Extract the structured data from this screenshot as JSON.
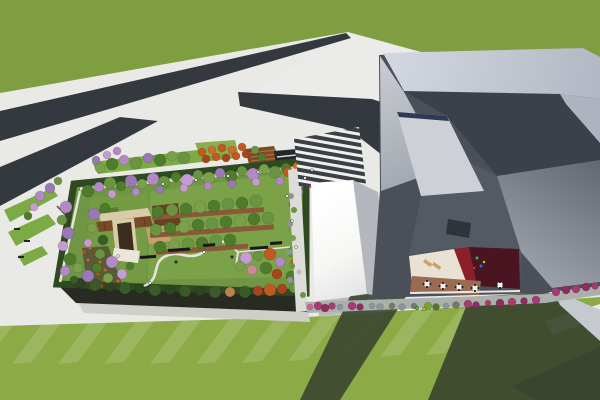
{
  "scene": {
    "type": "architectural-3d-rendering",
    "description": "Aerial view of a campus: low building with rooftop garden park, striped entry plaza, white service hall, large faceted gray museum-like building with inner courtyard cafe, roads crossing a grass field, lawns with long building shadows."
  },
  "palette": {
    "grass": "#7e9e40",
    "pavement": "#e9e9e6",
    "pavementWedge": "#ebebe9",
    "pavementShade": "#cfcfca",
    "road": "#34383f",
    "roadSE": "#3a3e45",
    "lawn": "#8caa45",
    "gardenLawn": "#6f9545",
    "gardenLawnLight": "#7ba249",
    "gardenLawnLeft": "#759c45",
    "hedge": "#2f4a21",
    "gardenFacade": "#272b22",
    "stripGreen": "#7cab45",
    "stripGreen2": "#86b04c",
    "amphitheater": "#7d4a26",
    "amphitheaterStep": "#a9713d",
    "shelter": "#23262b",
    "whiteRoofSide": "#b4b8be",
    "bldgBase": "#4a4f58",
    "bldgDarkNorth": "#3c4149",
    "bldgSouthWest": "#545a63",
    "bandRight": "#aeb3bf",
    "skylight": "#cdd1d7",
    "skylightStrip": "#2c3a55",
    "vent": "#2f343b",
    "courtyardCream": "#e9e1d4",
    "courtyardDarkRed": "#8c1f2a",
    "courtyardMaroon": "#4a1420",
    "courtyardTerracotta": "#9c6a50",
    "curb": "#e8e8e6",
    "walkwayBand": "#aab0ac",
    "rightWall": "#c6c9cd",
    "shadow": "#3a452e",
    "eastWalk": "#dcdcd8",
    "pathLight": "#e7e4da",
    "pergolaWood": "#7a4a28",
    "pergolaFrame": "#d8cba8",
    "pergolaInner": "#3a2d1e",
    "deck": "#c8a06b",
    "planterBox": "#6b3f22",
    "soil": "#4a4030",
    "zebraLight": "#f0f0ee",
    "zebraDark": "#3b3f46",
    "whitePath": "#e9eae8"
  },
  "vegetation": {
    "gardenNorthTrees": [
      [
        88,
        191,
        6,
        "#4e7c2c"
      ],
      [
        99,
        187,
        5,
        "#b487c6"
      ],
      [
        110,
        183,
        6,
        "#699441"
      ],
      [
        121,
        186,
        5,
        "#4e7c2c"
      ],
      [
        131,
        181,
        6,
        "#9a77b5"
      ],
      [
        142,
        184,
        5,
        "#7ba04b"
      ],
      [
        153,
        179,
        6,
        "#b487c6"
      ],
      [
        164,
        182,
        6,
        "#699441"
      ],
      [
        176,
        177,
        5,
        "#4e7c2c"
      ],
      [
        187,
        180,
        6,
        "#c79ad3"
      ],
      [
        198,
        175,
        5,
        "#699441"
      ],
      [
        209,
        178,
        6,
        "#7ba04b"
      ],
      [
        220,
        173,
        5,
        "#9a77b5"
      ],
      [
        231,
        176,
        6,
        "#4e7c2c"
      ],
      [
        242,
        171,
        5,
        "#699441"
      ],
      [
        253,
        174,
        6,
        "#b487c6"
      ],
      [
        264,
        169,
        5,
        "#7ba04b"
      ],
      [
        275,
        172,
        6,
        "#699441"
      ],
      [
        286,
        168,
        5,
        "#4e7c2c"
      ],
      [
        288,
        172,
        5,
        "#c2581f"
      ],
      [
        297,
        166,
        4,
        "#d06b28"
      ],
      [
        112,
        194,
        4,
        "#c79ad3"
      ],
      [
        136,
        192,
        4,
        "#b487c6"
      ],
      [
        160,
        190,
        4,
        "#9a77b5"
      ],
      [
        184,
        188,
        4,
        "#c79ad3"
      ],
      [
        208,
        186,
        4,
        "#b487c6"
      ],
      [
        232,
        184,
        4,
        "#9a77b5"
      ],
      [
        256,
        182,
        4,
        "#c79ad3"
      ],
      [
        280,
        181,
        4,
        "#b487c6"
      ]
    ],
    "gardenEastTrees": [
      [
        295,
        180,
        5,
        "#699441"
      ],
      [
        298,
        192,
        5,
        "#b487c6"
      ],
      [
        294,
        204,
        5,
        "#4e7c2c"
      ],
      [
        297,
        216,
        5,
        "#9a77b5"
      ],
      [
        293,
        228,
        5,
        "#7ba04b"
      ],
      [
        296,
        240,
        5,
        "#c79ad3"
      ],
      [
        292,
        252,
        5,
        "#699441"
      ],
      [
        295,
        264,
        5,
        "#c2641f"
      ],
      [
        291,
        276,
        5,
        "#4e7c2c"
      ]
    ],
    "gardenSouthTrees": [
      [
        80,
        283,
        5,
        "#2c451e"
      ],
      [
        95,
        285,
        6,
        "#3a5a28"
      ],
      [
        110,
        287,
        5,
        "#2c451e"
      ],
      [
        125,
        288,
        6,
        "#3a5a28"
      ],
      [
        140,
        289,
        5,
        "#2c451e"
      ],
      [
        155,
        290,
        6,
        "#3a5a28"
      ],
      [
        170,
        290,
        5,
        "#2c451e"
      ],
      [
        185,
        291,
        6,
        "#3a5a28"
      ],
      [
        200,
        291,
        5,
        "#2c451e"
      ],
      [
        215,
        292,
        6,
        "#3a5a28"
      ],
      [
        230,
        292,
        5,
        "#b9844b"
      ],
      [
        245,
        292,
        6,
        "#3a5a28"
      ],
      [
        258,
        291,
        5,
        "#a8431a"
      ],
      [
        270,
        290,
        6,
        "#c2581f"
      ],
      [
        282,
        289,
        5,
        "#a8431a"
      ],
      [
        294,
        288,
        5,
        "#699441"
      ]
    ],
    "gardenWestTrees": [
      [
        66,
        207,
        6,
        "#b487c6"
      ],
      [
        62,
        220,
        5,
        "#699441"
      ],
      [
        68,
        233,
        6,
        "#9a77b5"
      ],
      [
        63,
        246,
        5,
        "#c79ad3"
      ],
      [
        70,
        259,
        6,
        "#4e7c2c"
      ],
      [
        65,
        271,
        5,
        "#b487c6"
      ],
      [
        78,
        268,
        5,
        "#7ba04b"
      ],
      [
        74,
        280,
        4,
        "#3a5a28"
      ]
    ],
    "gardenRowTrees": [
      [
        158,
        212,
        6,
        "#4e7c2c"
      ],
      [
        172,
        210,
        6,
        "#699441"
      ],
      [
        186,
        209,
        6,
        "#4e7c2c"
      ],
      [
        200,
        207,
        6,
        "#7ba04b"
      ],
      [
        214,
        206,
        6,
        "#4e7c2c"
      ],
      [
        228,
        204,
        6,
        "#699441"
      ],
      [
        242,
        203,
        6,
        "#4e7c2c"
      ],
      [
        256,
        201,
        6,
        "#699441"
      ],
      [
        156,
        230,
        6,
        "#699441"
      ],
      [
        170,
        228,
        6,
        "#4e7c2c"
      ],
      [
        184,
        227,
        6,
        "#7ba04b"
      ],
      [
        198,
        225,
        6,
        "#4e7c2c"
      ],
      [
        212,
        224,
        6,
        "#699441"
      ],
      [
        226,
        222,
        6,
        "#4e7c2c"
      ],
      [
        240,
        221,
        6,
        "#7ba04b"
      ],
      [
        254,
        219,
        6,
        "#4e7c2c"
      ],
      [
        268,
        218,
        6,
        "#699441"
      ],
      [
        160,
        247,
        6,
        "#4e7c2c"
      ],
      [
        174,
        246,
        6,
        "#7ba04b"
      ],
      [
        188,
        244,
        6,
        "#699441"
      ],
      [
        202,
        243,
        6,
        "#4e7c2c"
      ],
      [
        216,
        241,
        6,
        "#699441"
      ],
      [
        230,
        240,
        6,
        "#4e7c2c"
      ]
    ],
    "gardenSECluster": [
      [
        246,
        258,
        6,
        "#c79ad3"
      ],
      [
        258,
        256,
        5,
        "#699441"
      ],
      [
        270,
        254,
        6,
        "#c2581f"
      ],
      [
        280,
        262,
        5,
        "#b487c6"
      ],
      [
        266,
        268,
        6,
        "#4e7c2c"
      ],
      [
        252,
        270,
        5,
        "#c9899a"
      ],
      [
        240,
        266,
        5,
        "#7ba04b"
      ],
      [
        277,
        274,
        5,
        "#a8431a"
      ]
    ],
    "gardenNWCluster": [
      [
        94,
        214,
        6,
        "#9a77b5"
      ],
      [
        105,
        208,
        5,
        "#4e7c2c"
      ],
      [
        92,
        228,
        5,
        "#7ba04b"
      ],
      [
        103,
        240,
        5,
        "#3a5a28"
      ],
      [
        88,
        243,
        4,
        "#c79ad3"
      ],
      [
        100,
        254,
        5,
        "#699441"
      ],
      [
        112,
        262,
        6,
        "#b487c6"
      ],
      [
        97,
        268,
        5,
        "#4e7c2c"
      ],
      [
        88,
        276,
        6,
        "#9a77b5"
      ],
      [
        108,
        278,
        5,
        "#7ba04b"
      ],
      [
        122,
        274,
        5,
        "#c79ad3"
      ],
      [
        130,
        266,
        4,
        "#4e7c2c"
      ]
    ],
    "northStripTrees": [
      [
        100,
        168,
        5,
        "#7ba04b"
      ],
      [
        112,
        164,
        6,
        "#4e7c2c"
      ],
      [
        124,
        160,
        5,
        "#b487c6"
      ],
      [
        136,
        163,
        6,
        "#699441"
      ],
      [
        148,
        158,
        5,
        "#9a77b5"
      ],
      [
        160,
        160,
        6,
        "#4e7c2c"
      ],
      [
        172,
        156,
        5,
        "#7ba04b"
      ],
      [
        184,
        158,
        6,
        "#699441"
      ],
      [
        202,
        152,
        4,
        "#c2581f"
      ],
      [
        212,
        150,
        4,
        "#d06b28"
      ],
      [
        222,
        148,
        4,
        "#c2581f"
      ],
      [
        232,
        150,
        4,
        "#d06b28"
      ],
      [
        242,
        147,
        4,
        "#c2581f"
      ],
      [
        206,
        159,
        4,
        "#a8431a"
      ],
      [
        216,
        157,
        4,
        "#c2581f"
      ],
      [
        226,
        158,
        4,
        "#a8431a"
      ],
      [
        236,
        156,
        4,
        "#c2581f"
      ],
      [
        246,
        154,
        4,
        "#a8431a"
      ],
      [
        255,
        150,
        4,
        "#699441"
      ],
      [
        262,
        157,
        4,
        "#4e7c2c"
      ],
      [
        107,
        155,
        4,
        "#c79ad3"
      ],
      [
        117,
        151,
        4,
        "#b487c6"
      ],
      [
        96,
        160,
        4,
        "#9a77b5"
      ]
    ],
    "leftStripTrees": [
      [
        40,
        196,
        5,
        "#b487c6"
      ],
      [
        50,
        188,
        5,
        "#9a77b5"
      ],
      [
        58,
        181,
        4,
        "#699441"
      ],
      [
        34,
        207,
        4,
        "#c79ad3"
      ],
      [
        28,
        216,
        4,
        "#4e7c2c"
      ]
    ],
    "eastWalkBushes": [
      [
        291,
        196,
        3,
        "#8f949a"
      ],
      [
        294,
        210,
        3,
        "#699441"
      ],
      [
        290,
        224,
        3,
        "#8f949a"
      ],
      [
        293,
        238,
        3,
        "#7ba04b"
      ],
      [
        289,
        252,
        3,
        "#8f949a"
      ],
      [
        292,
        266,
        3,
        "#699441"
      ],
      [
        290,
        280,
        3,
        "#8f949a"
      ],
      [
        303,
        295,
        3,
        "#699441"
      ]
    ],
    "zebraFlowers": [
      [
        312,
        186,
        2.5,
        "#a83a72"
      ],
      [
        318,
        188,
        2.5,
        "#e8e4ea"
      ],
      [
        324,
        186,
        2.5,
        "#c66292"
      ],
      [
        330,
        188,
        2.5,
        "#a83a72"
      ],
      [
        336,
        187,
        2.5,
        "#e8e4ea"
      ],
      [
        342,
        188,
        2.5,
        "#a83a72"
      ],
      [
        348,
        189,
        2.5,
        "#c66292"
      ],
      [
        354,
        190,
        2.5,
        "#a83a72"
      ]
    ],
    "southBushes": [
      [
        310,
        307,
        3,
        "#c66292"
      ],
      [
        318,
        306,
        4,
        "#a83a72"
      ],
      [
        325,
        308,
        4,
        "#8e2d5f"
      ],
      [
        332,
        306,
        3.5,
        "#a83a72"
      ],
      [
        340,
        307,
        3,
        "#8f949a"
      ],
      [
        352,
        306,
        4,
        "#a83a72"
      ],
      [
        360,
        307,
        3.5,
        "#8e2d5f"
      ],
      [
        372,
        306,
        3,
        "#8f949a"
      ],
      [
        380,
        307,
        3.5,
        "#8f949a"
      ],
      [
        392,
        306,
        3,
        "#747a6a"
      ],
      [
        402,
        307,
        3.5,
        "#8f949a"
      ],
      [
        414,
        306,
        3,
        "#747a6a"
      ],
      [
        428,
        306,
        4,
        "#7da03a"
      ],
      [
        436,
        307,
        3.5,
        "#55752c"
      ],
      [
        446,
        306,
        3,
        "#8f949a"
      ],
      [
        456,
        305,
        3.5,
        "#747a6a"
      ],
      [
        468,
        304,
        4,
        "#a83a72"
      ],
      [
        476,
        305,
        3.5,
        "#8e2d5f"
      ],
      [
        488,
        303,
        3,
        "#a83a72"
      ],
      [
        500,
        303,
        4,
        "#8e2d5f"
      ],
      [
        512,
        302,
        4,
        "#a83a72"
      ],
      [
        524,
        301,
        3.5,
        "#8e2d5f"
      ],
      [
        536,
        300,
        4,
        "#a83a72"
      ],
      [
        556,
        292,
        4,
        "#a83a72"
      ],
      [
        566,
        290,
        4,
        "#8e2d5f"
      ],
      [
        576,
        289,
        4,
        "#a83a72"
      ],
      [
        586,
        287,
        4,
        "#8e2d5f"
      ],
      [
        595,
        286,
        3.5,
        "#a83a72"
      ]
    ],
    "redFlowerBed": [
      [
        84,
        252,
        1.8,
        "#cf4418"
      ],
      [
        90,
        248,
        1.5,
        "#e25b28"
      ],
      [
        96,
        255,
        1.8,
        "#cf4418"
      ],
      [
        88,
        260,
        1.5,
        "#e25b28"
      ],
      [
        94,
        266,
        1.8,
        "#cf4418"
      ],
      [
        100,
        262,
        1.5,
        "#e25b28"
      ],
      [
        86,
        272,
        1.8,
        "#cf4418"
      ],
      [
        92,
        278,
        1.5,
        "#e25b28"
      ],
      [
        98,
        274,
        1.8,
        "#cf4418"
      ],
      [
        104,
        280,
        1.5,
        "#e25b28"
      ],
      [
        110,
        277,
        1.8,
        "#cf4418"
      ],
      [
        105,
        270,
        1.5,
        "#e25b28"
      ],
      [
        112,
        284,
        1.8,
        "#cf4418"
      ],
      [
        118,
        281,
        1.5,
        "#e25b28"
      ],
      [
        101,
        286,
        1.8,
        "#cf4418"
      ]
    ]
  },
  "furniture": {
    "planterStrips": [
      [
        152,
        215,
        112,
        5,
        -4,
        "#8a5a38"
      ],
      [
        150,
        233,
        124,
        5,
        -4,
        "#8a5a38"
      ],
      [
        156,
        250,
        92,
        5,
        -4,
        "#8a5a38"
      ]
    ],
    "benches": [
      [
        168,
        249,
        22,
        3,
        -4,
        "#17181a"
      ],
      [
        203,
        244,
        12,
        3,
        -4,
        "#17181a"
      ],
      [
        140,
        256,
        16,
        3,
        -4,
        "#17181a"
      ],
      [
        250,
        247,
        18,
        3,
        -4,
        "#17181a"
      ],
      [
        270,
        242,
        12,
        3,
        -4,
        "#17181a"
      ],
      [
        14,
        228,
        6,
        2,
        0,
        "#222426"
      ],
      [
        24,
        240,
        6,
        2,
        0,
        "#222426"
      ],
      [
        18,
        256,
        6,
        2,
        0,
        "#222426"
      ]
    ],
    "loungeChairs": [
      [
        425,
        259,
        9,
        3.5,
        35,
        "#c8a46a"
      ],
      [
        434,
        262,
        9,
        3.5,
        35,
        "#c8a46a"
      ]
    ]
  },
  "courtyard": {
    "tables": [
      [
        427,
        284
      ],
      [
        443,
        286
      ],
      [
        459,
        287
      ],
      [
        475,
        288
      ],
      [
        500,
        285
      ]
    ],
    "people": [
      [
        477,
        258,
        1.7,
        "#3fae4a"
      ],
      [
        481,
        266,
        1.7,
        "#2f6fd0"
      ],
      [
        484,
        262,
        1.5,
        "#d8b332"
      ],
      [
        474,
        268,
        1.5,
        "#c03a3a"
      ]
    ]
  },
  "people": {
    "promenade": [
      [
        163,
        184,
        1.4,
        "#f2f2f2"
      ],
      [
        196,
        180,
        1.4,
        "#e8e8e8"
      ],
      [
        228,
        176,
        1.4,
        "#f2f2f2"
      ],
      [
        258,
        172,
        1.4,
        "#dadada"
      ],
      [
        287,
        196,
        1.4,
        "#f2f2f2"
      ],
      [
        292,
        221,
        1.4,
        "#e8e8e8"
      ],
      [
        296,
        247,
        1.4,
        "#f2f2f2"
      ],
      [
        299,
        272,
        1.4,
        "#e2e2e2"
      ],
      [
        305,
        178,
        1.4,
        "#f2f2f2"
      ],
      [
        312,
        170,
        1.4,
        "#e8e8e8"
      ]
    ],
    "garden": [
      [
        150,
        283,
        1.4,
        "#f4f4f0"
      ],
      [
        176,
        262,
        1.4,
        "#2a2c2e"
      ],
      [
        204,
        252,
        1.4,
        "#f4f4f0"
      ],
      [
        232,
        257,
        1.4,
        "#2a2c2e"
      ],
      [
        118,
        256,
        1.4,
        "#f4f4f0"
      ]
    ],
    "southWalk": [
      [
        417,
        308,
        1.7,
        "#49b54f"
      ],
      [
        424,
        309,
        1.7,
        "#b9c93e"
      ]
    ]
  }
}
